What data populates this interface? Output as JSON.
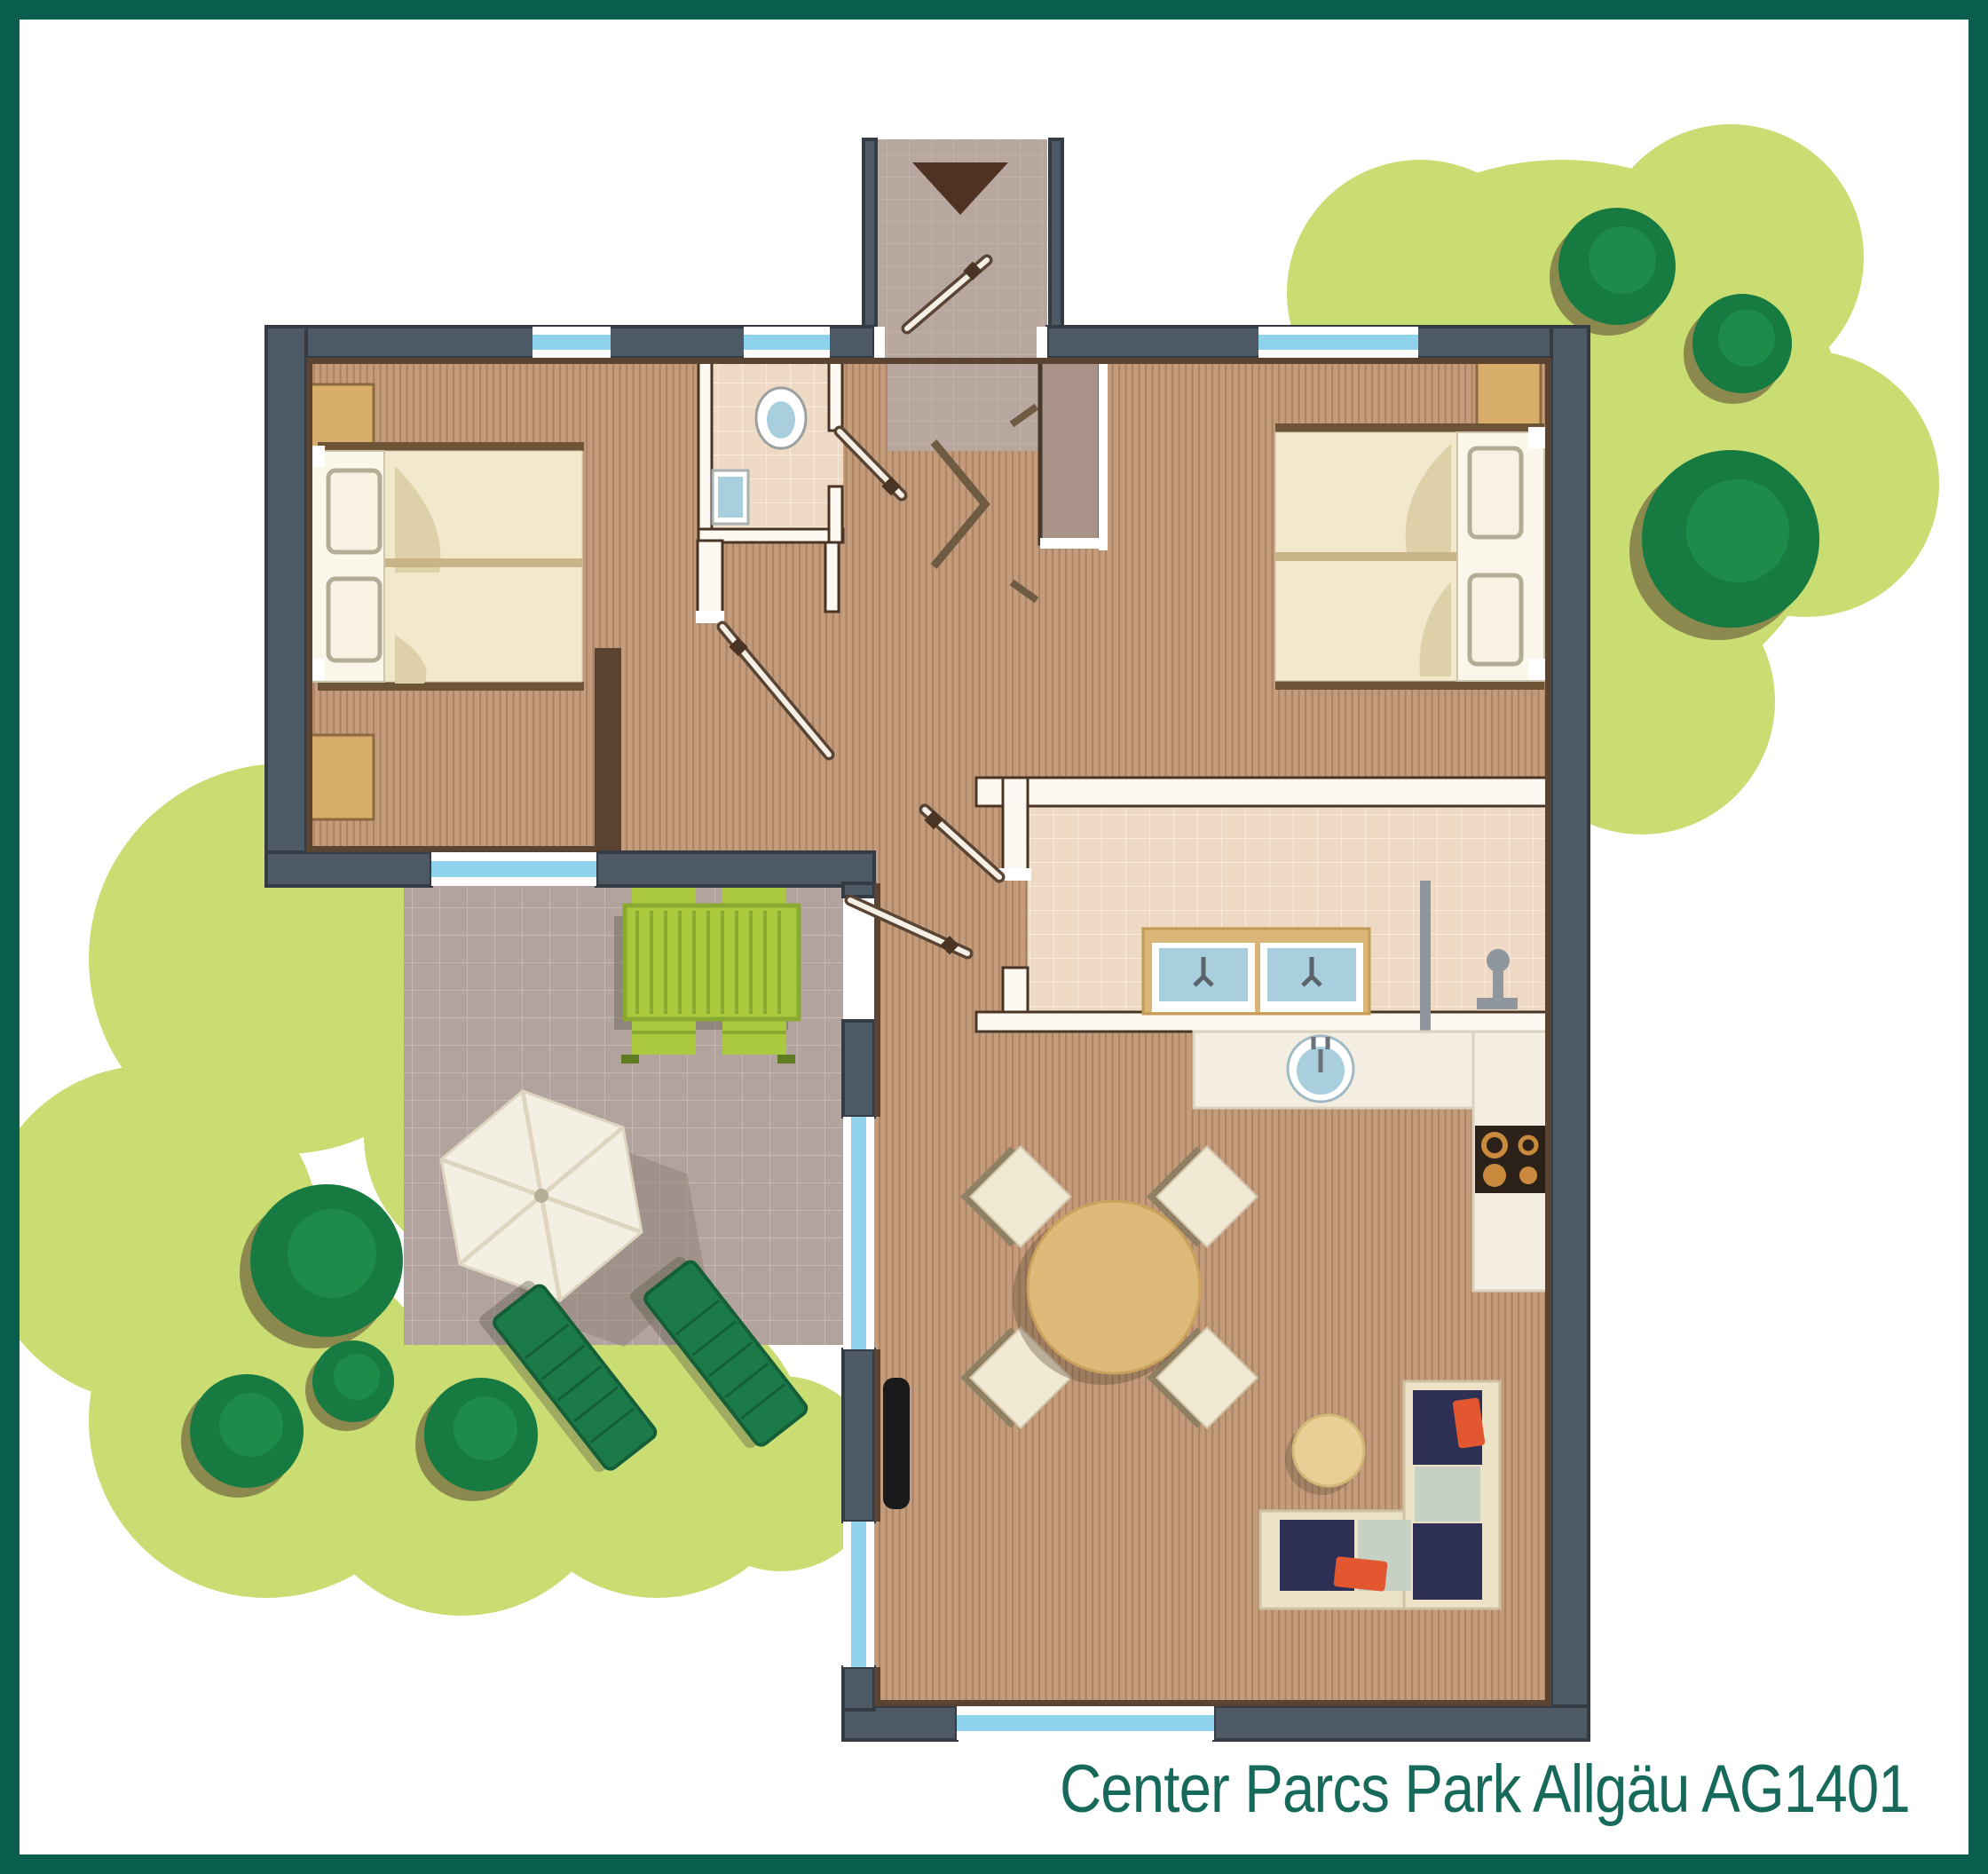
{
  "caption": {
    "text": "Center Parcs Park Allgäu AG1401"
  },
  "colors": {
    "frame": "#0a5e4e",
    "caption": "#17695a",
    "grass": "#c9dd73",
    "treeBody": "#177a40",
    "treeInner": "#1f8b4b",
    "treeShadow": "#8c894f",
    "wall": "#4d5965",
    "wallEdge": "#353b43",
    "innerLine": "#5a4431",
    "wood": "#c59c7b",
    "woodStripe": "#ab8465",
    "tile": "#eedac4",
    "tileGrid": "#f8ebdc",
    "terrace": "#b3a39e",
    "terraceGrid": "#c5b8b3",
    "entry": "#b7a79f",
    "glass": "#8fd2ec",
    "trim": "#ffffff",
    "partition": "#fdf9f2",
    "partitionEdge": "#4a3525",
    "door": "#f5efe6",
    "doorEdge": "#5a4433",
    "handle": "#4a3525",
    "duvet": "#f2e8cb",
    "duvetSplit": "#c9b488",
    "duvetFold": "#ded1a9",
    "headboard": "#faf6ea",
    "pillow": "#f7f2e2",
    "pillowEdge": "#b4ad96",
    "bedBar": "#6d5437",
    "nightstand": "#d9ae6b",
    "nightstandEdge": "#8a6a3e",
    "wardrobe": "#a99389",
    "wardrobeEdge": "#46392c",
    "counter": "#f3eee1",
    "counterEdge": "#d9d2bf",
    "stove": "#2b2119",
    "burner": "#c98a3e",
    "sinkBlue": "#a9cede",
    "sinkTrim": "#ffffff",
    "fixture": "#8f969e",
    "tableTop": "#ddb97a",
    "tableEdge": "#caa25c",
    "chair": "#f0e9d4",
    "chairShadow": "#8f7f63",
    "pouf": "#e9cf96",
    "poufEdge": "#d4b877",
    "sofaBase": "#ece2c8",
    "sofaNavy": "#2d3054",
    "sofaSage": "#c7d1c3",
    "sofaOrange": "#e2572f",
    "picnic": "#aac93f",
    "picnicEdge": "#8aa92f",
    "picnicDark": "#5f7c22",
    "lounger": "#1c7a49",
    "loungerEdge": "#145f38",
    "parasol": "#f3efe2",
    "parasolSeam": "#ddd5c0",
    "parasolShadow": "#8d8276",
    "arrow": "#4f3222",
    "tv": "#1a1a1c",
    "toiletBlue": "#a9cede",
    "shadow": "#6b5a48"
  }
}
